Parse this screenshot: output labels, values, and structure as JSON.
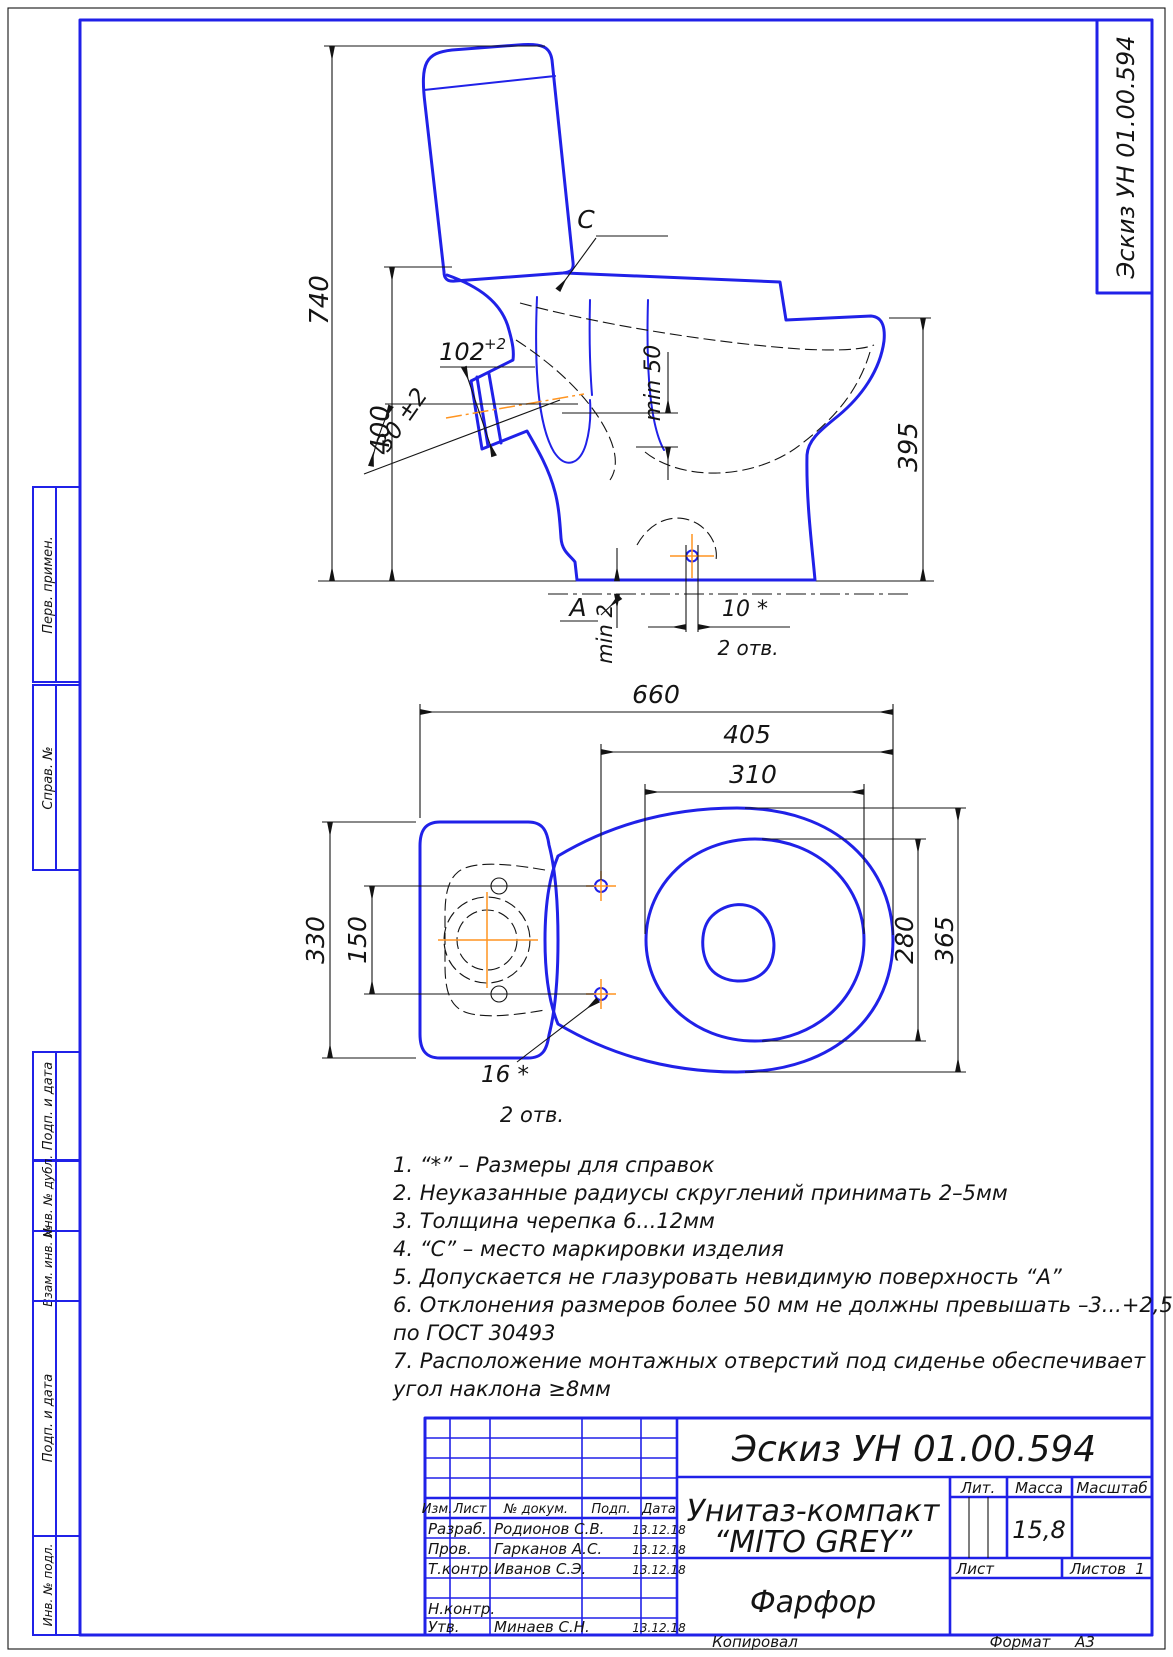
{
  "page": {
    "copied_label": "Копировал",
    "format_label": "Формат",
    "format_value": "А3"
  },
  "margins": {
    "top_right_title": "Эскиз УН 01.00.594",
    "left_labels": [
      "Перв. примен.",
      "Справ. №",
      "Подп. и дата",
      "Инв. № дубл.",
      "Взам. инв. №",
      "Подп. и дата",
      "Инв. № подл."
    ]
  },
  "side_view": {
    "d740": "740",
    "d400": "400",
    "d395": "395",
    "d102": "102",
    "d102_tol": "+2",
    "d30": "30 ±2",
    "dmin50": "min 50",
    "dmin2": "min 2",
    "d10": "10 *",
    "d2otv": "2 отв.",
    "label_c": "C",
    "label_a": "A"
  },
  "plan_view": {
    "d660": "660",
    "d405": "405",
    "d310": "310",
    "d330": "330",
    "d150": "150",
    "d280": "280",
    "d365": "365",
    "d16": "16 *",
    "d2otv": "2 отв."
  },
  "notes": {
    "lines": [
      "1. “*” – Размеры для справок",
      "2. Неуказанные радиусы скруглений принимать 2–5мм",
      "3. Толщина черепка 6...12мм",
      "4. “С” – место маркировки изделия",
      "5. Допускается не глазуровать невидимую поверхность “А”",
      "6. Отклонения размеров более 50 мм не должны превышать –3...+2,5%",
      "по ГОСТ 30493",
      "7. Расположение монтажных отверстий под сиденье обеспечивает",
      "угол наклона ≥8мм"
    ]
  },
  "title_block": {
    "doc_number": "Эскиз УН 01.00.594",
    "product_line1": "Унитаз-компакт",
    "product_line2": "“MITO GREY”",
    "material": "Фарфор",
    "lit_label": "Лит.",
    "mass_label": "Масса",
    "scale_label": "Масштаб",
    "mass_value": "15,8",
    "sheet_label": "Лист",
    "sheets_label": "Листов",
    "sheets_value": "1",
    "header": {
      "izm": "Изм.",
      "list": "Лист",
      "doc": "№ докум.",
      "sign": "Подп.",
      "date": "Дата"
    },
    "rows": [
      {
        "role": "Разраб.",
        "name": "Родионов С.В.",
        "date": "13.12.18"
      },
      {
        "role": "Пров.",
        "name": "Гарканов А.С.",
        "date": "13.12.18"
      },
      {
        "role": "Т.контр.",
        "name": "Иванов С.Э.",
        "date": "13.12.18"
      },
      {
        "role": "",
        "name": "",
        "date": ""
      },
      {
        "role": "Н.контр.",
        "name": "",
        "date": ""
      },
      {
        "role": "Утв.",
        "name": "Минаев С.Н.",
        "date": "13.12.18"
      }
    ]
  },
  "colors": {
    "line_blue": "#2021e8",
    "accent_orange": "#ff9420",
    "ink": "#141414"
  }
}
